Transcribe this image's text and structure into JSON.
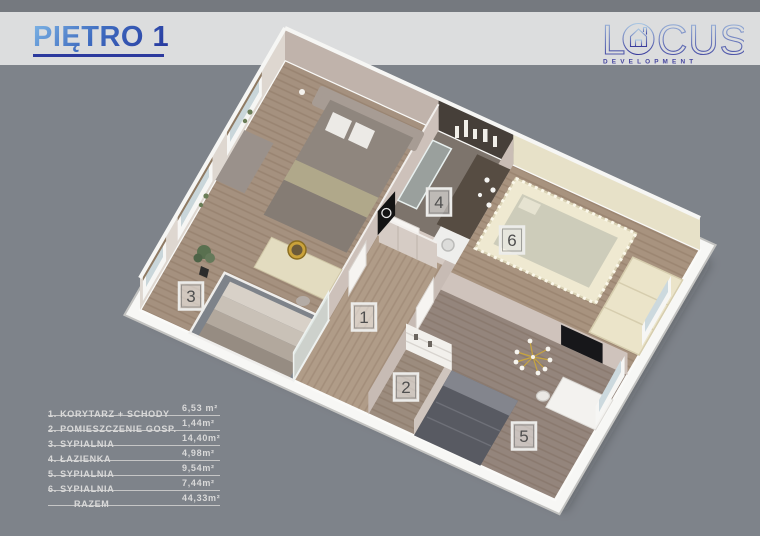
{
  "colors": {
    "background": "#7e838a",
    "header_band": "#dcddde",
    "title_blue_light": "#7fb6e6",
    "title_blue_dark": "#24349c",
    "logo_blue": "#45459e",
    "legend_text": "#d9d9d9"
  },
  "header": {
    "title": "PIĘTRO 1"
  },
  "logo": {
    "word_l": "L",
    "word_rest": "CUS",
    "house_icon": "house-in-letter-o",
    "subtitle": "D E V E L O P M E N T"
  },
  "legend": {
    "rows": [
      {
        "no": "1",
        "label": "1. KORYTARZ + SCHODY",
        "area": "6,53 m²"
      },
      {
        "no": "2",
        "label": "2. POMIESZCZENIE GOSP.",
        "area": "1,44m²"
      },
      {
        "no": "3",
        "label": "3. SYPIALNIA",
        "area": "14,40m²"
      },
      {
        "no": "4",
        "label": "4. ŁAZIENKA",
        "area": "4,98m²"
      },
      {
        "no": "5",
        "label": "5. SYPIALNIA",
        "area": "9,54m²"
      },
      {
        "no": "6",
        "label": "6. SYPIALNIA",
        "area": "7,44m²"
      }
    ],
    "total": {
      "label": "RAZEM",
      "area": "44,33m²"
    }
  },
  "plan": {
    "badges": [
      "1",
      "2",
      "3",
      "4",
      "5",
      "6"
    ]
  }
}
